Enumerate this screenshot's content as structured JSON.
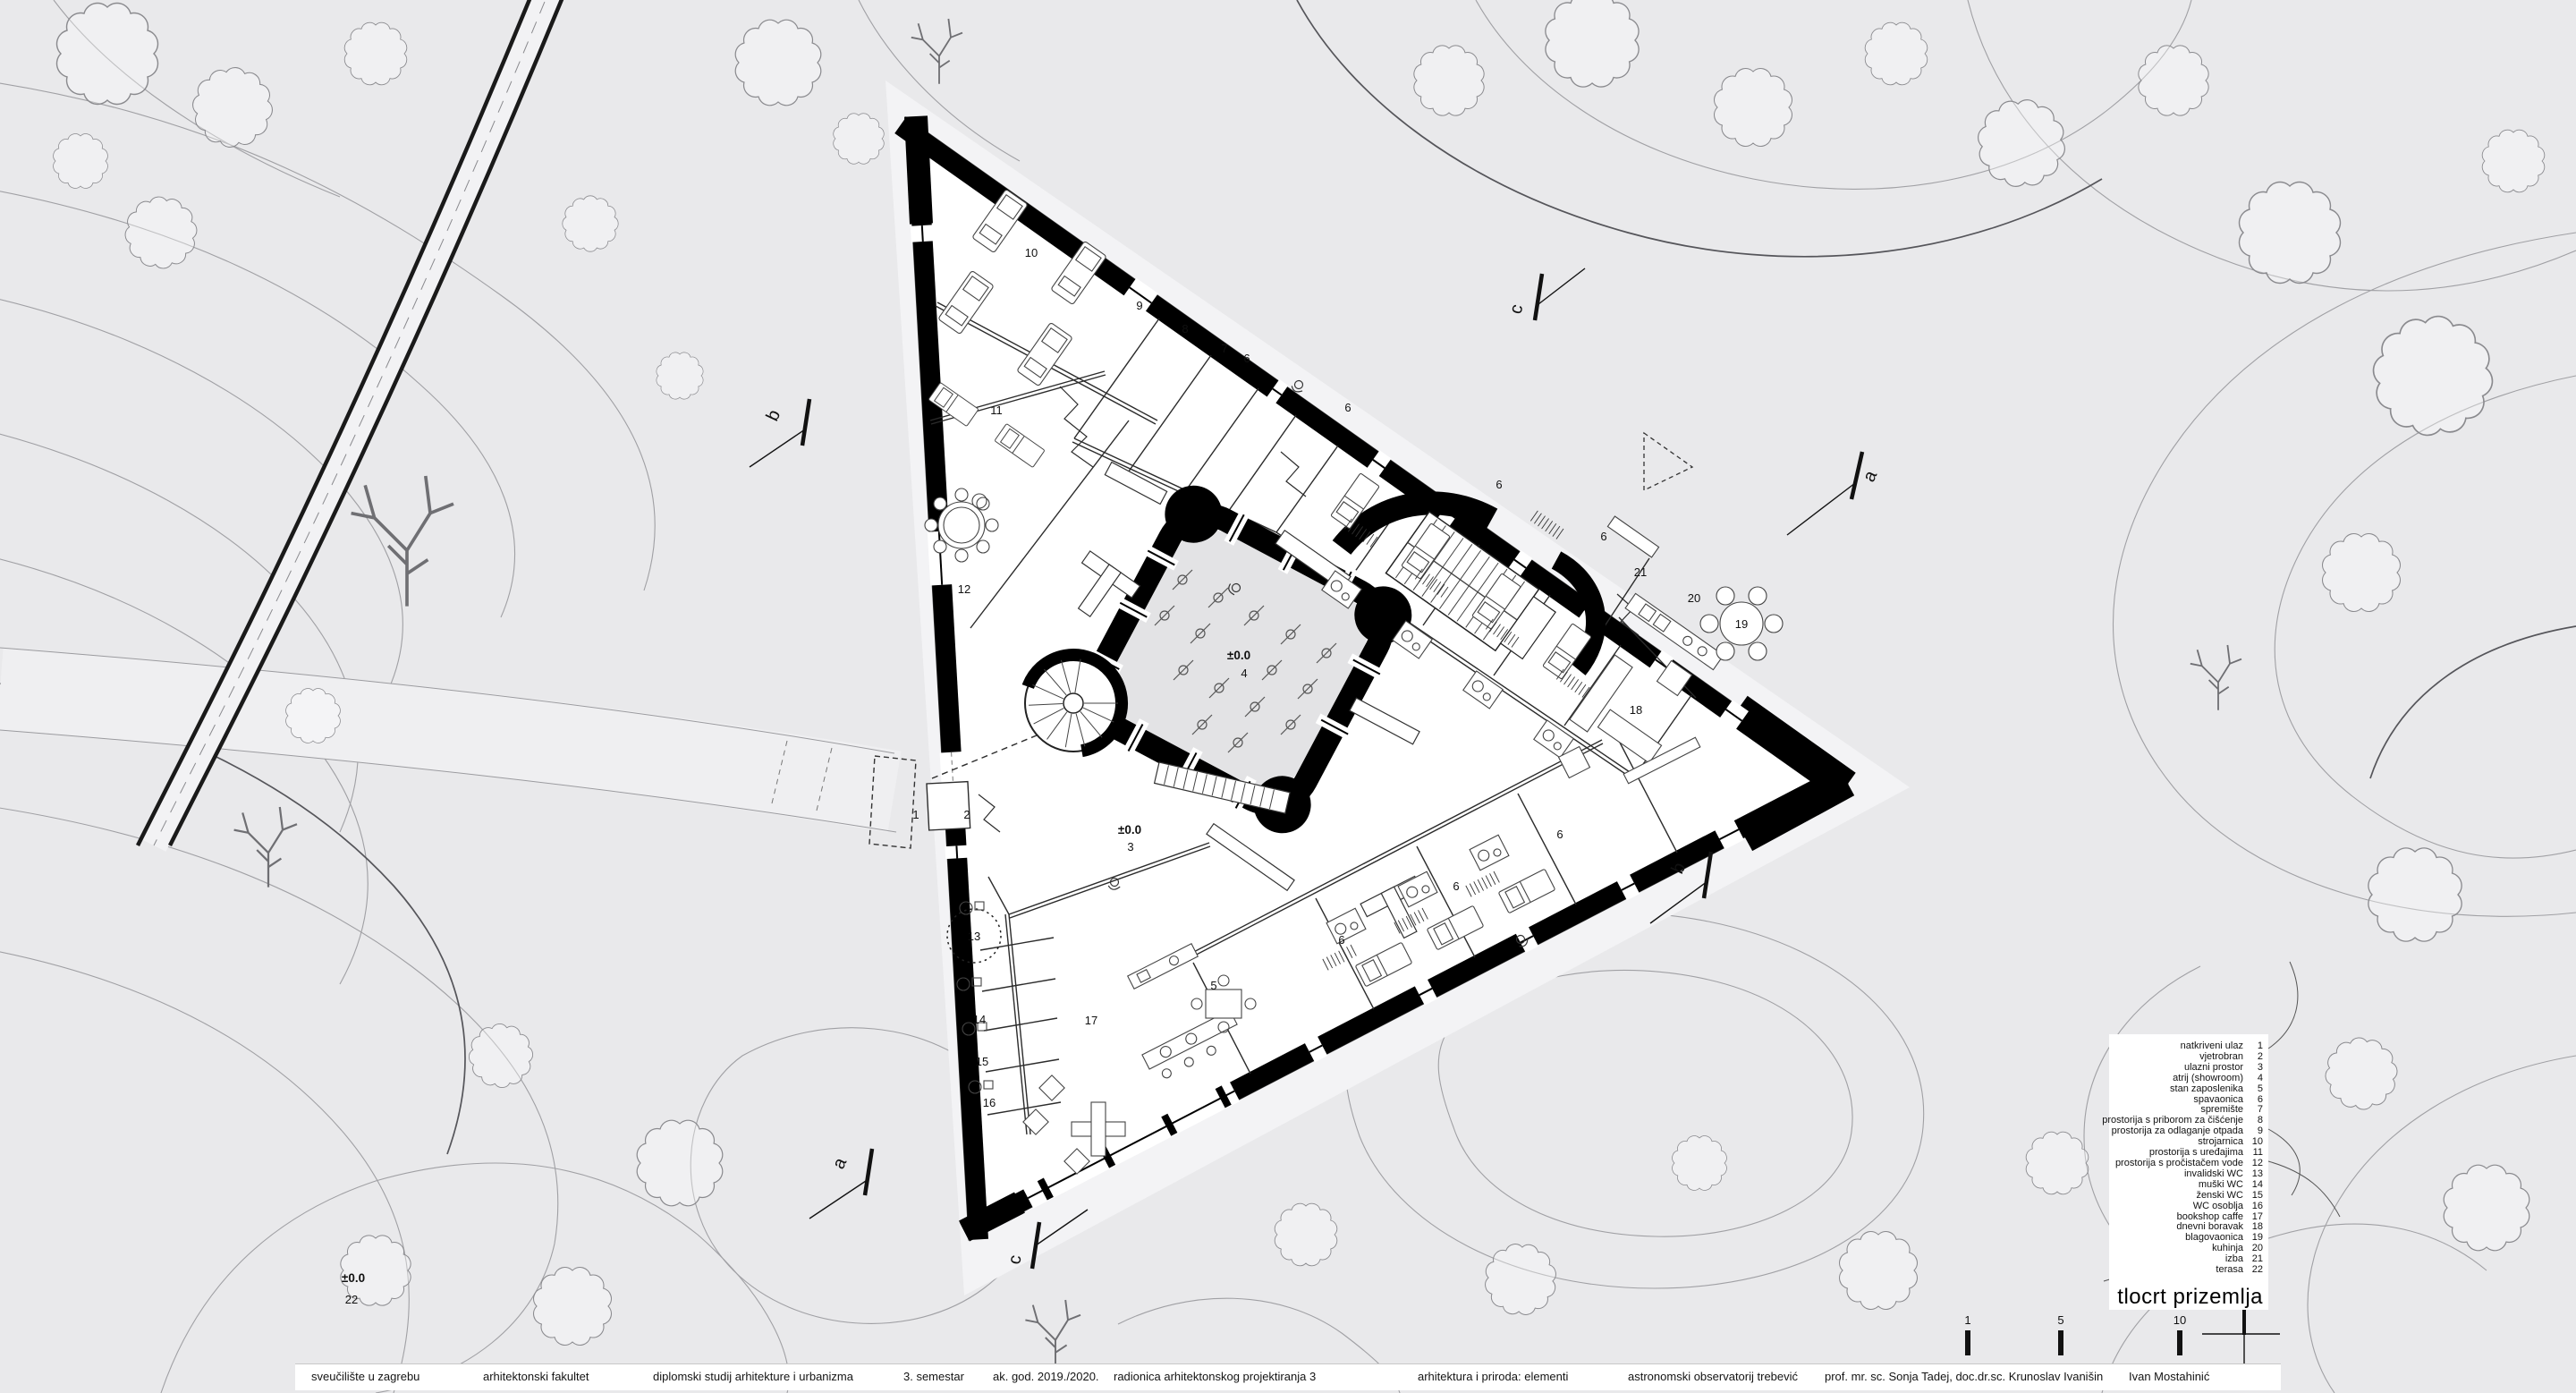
{
  "title": "tlocrt prizemlja",
  "legend": {
    "items": [
      {
        "label": "natkriveni ulaz",
        "num": "1"
      },
      {
        "label": "vjetrobran",
        "num": "2"
      },
      {
        "label": "ulazni prostor",
        "num": "3"
      },
      {
        "label": "atrij (showroom)",
        "num": "4"
      },
      {
        "label": "stan zaposlenika",
        "num": "5"
      },
      {
        "label": "spavaonica",
        "num": "6"
      },
      {
        "label": "spremište",
        "num": "7"
      },
      {
        "label": "prostorija s priborom za čišćenje",
        "num": "8"
      },
      {
        "label": "prostorija za odlaganje otpada",
        "num": "9"
      },
      {
        "label": "strojarnica",
        "num": "10"
      },
      {
        "label": "prostorija s uređajima",
        "num": "11"
      },
      {
        "label": "prostorija s pročistačem vode",
        "num": "12"
      },
      {
        "label": "invalidski WC",
        "num": "13"
      },
      {
        "label": "muški WC",
        "num": "14"
      },
      {
        "label": "ženski WC",
        "num": "15"
      },
      {
        "label": "WC osoblja",
        "num": "16"
      },
      {
        "label": "bookshop caffe",
        "num": "17"
      },
      {
        "label": "dnevni boravak",
        "num": "18"
      },
      {
        "label": "blagovaonica",
        "num": "19"
      },
      {
        "label": "kuhinja",
        "num": "20"
      },
      {
        "label": "izba",
        "num": "21"
      },
      {
        "label": "terasa",
        "num": "22"
      }
    ]
  },
  "plan": {
    "labels": [
      "10",
      "9",
      "8",
      "7",
      "6",
      "6",
      "6",
      "6",
      "11",
      "12",
      "21",
      "20",
      "19",
      "18",
      "1",
      "2",
      "3",
      "13",
      "14",
      "15",
      "16",
      "17",
      "5",
      "6",
      "6",
      "6",
      "4"
    ],
    "atrium_level": "±0.0",
    "entrance_level": "±0.0",
    "site_level": "±0.0",
    "site_room": "22"
  },
  "sections": {
    "a": "a",
    "b": "b",
    "c": "c"
  },
  "scalebar": {
    "ticks": [
      "1",
      "5",
      "10"
    ]
  },
  "footer": {
    "items": [
      "sveučilište u zagrebu",
      "arhitektonski fakultet",
      "diplomski studij arhitekture i urbanizma",
      "3. semestar",
      "ak. god. 2019./2020.",
      "radionica arhitektonskog projektiranja 3",
      "arhitektura i priroda: elementi",
      "astronomski observatorij trebević",
      "prof. mr. sc. Sonja Tadej, doc.dr.sc. Krunoslav Ivanišin",
      "Ivan Mostahinić"
    ]
  }
}
